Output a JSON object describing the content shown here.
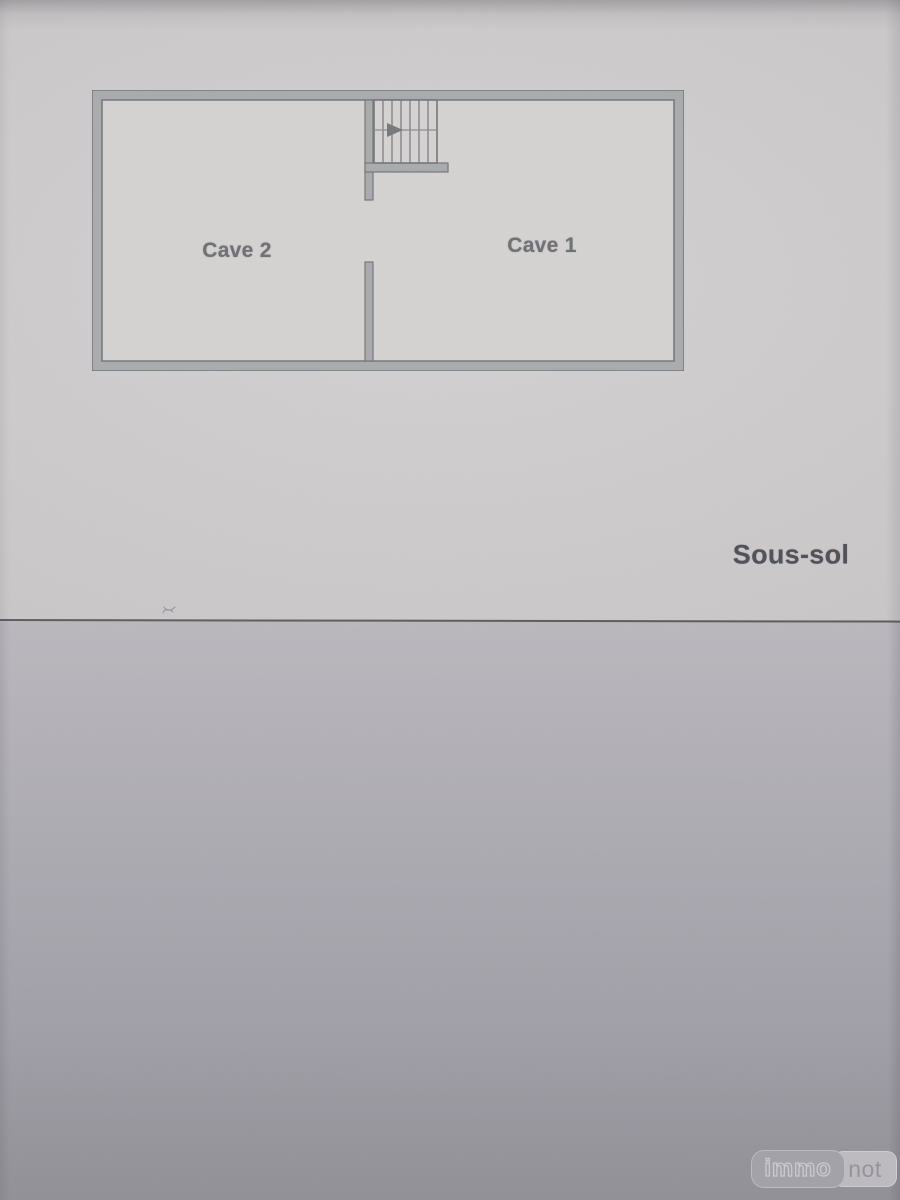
{
  "plan": {
    "rooms": [
      {
        "label": "Cave 2"
      },
      {
        "label": "Cave 1"
      }
    ],
    "floor_label": "Sous-sol",
    "icons": {
      "staircase": "staircase-icon",
      "direction_arrow": "arrow-right-icon",
      "stray_mark": "pen-scribble-icon"
    }
  },
  "watermark": {
    "brand_left": "immo",
    "brand_right": "not"
  },
  "colors": {
    "paper_top": "#cfcccd",
    "plan_interior": "#d5d3d2",
    "wall_fill": "#a9abad",
    "wall_stroke": "#75777a",
    "room_label": "#6e7073",
    "floor_label": "#4f5157",
    "divider_line": "#4a4a50",
    "paper_bottom_top": "#bab8bd",
    "paper_bottom_bottom": "#929097",
    "watermark_immo_bg": "#a5a3aa",
    "watermark_not_bg": "#c0bec3"
  }
}
